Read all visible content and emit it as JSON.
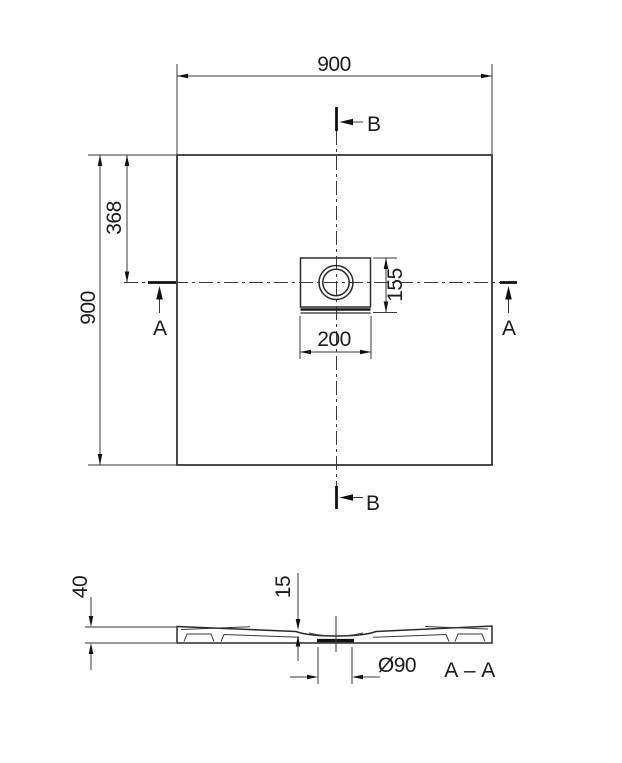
{
  "plan_view": {
    "dims": {
      "overall_width": "900",
      "overall_height": "900",
      "drain_center_from_top": "368",
      "drain_plate_height": "155",
      "drain_plate_width": "200"
    },
    "section_markers": {
      "a_left": "A",
      "a_right": "A",
      "b_top": "B",
      "b_bottom": "B"
    }
  },
  "section_view": {
    "dims": {
      "overall_height": "40",
      "drain_area_thickness": "15",
      "drain_diameter": "Ø90"
    },
    "label": "A – A"
  },
  "colors": {
    "background": "#ffffff",
    "line": "#2b2b2b",
    "text": "#1c1c1c"
  }
}
